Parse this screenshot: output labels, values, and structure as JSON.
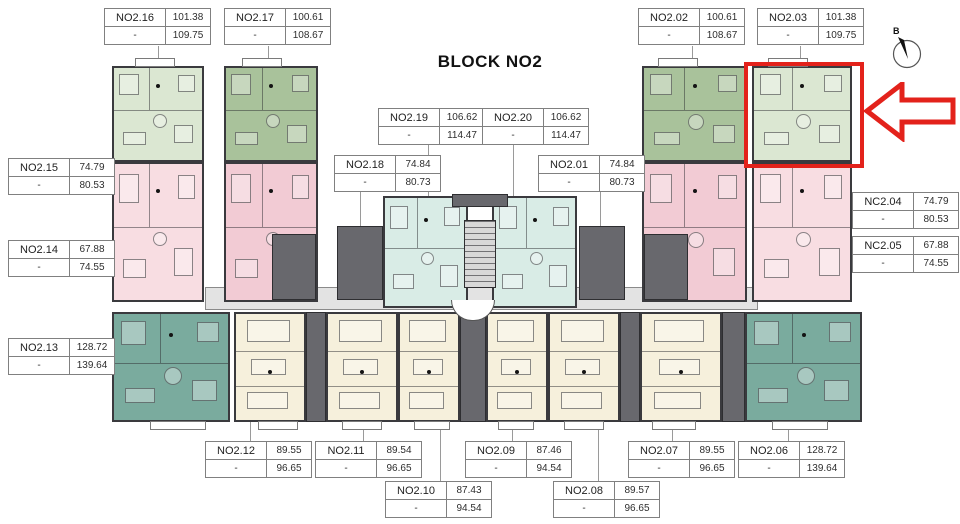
{
  "title": "BLOCK NO2",
  "compass_label": "B",
  "dash": "-",
  "highlighted_unit": "NO2.03",
  "colors": {
    "sage": "#a9c29b",
    "sage_light": "#dbe7d2",
    "pink": "#f2cbd4",
    "pink_light": "#f8dde2",
    "teal": "#7aab9e",
    "teal_light": "#d9ece6",
    "cream": "#f6f0dc",
    "core_gray": "#68686d",
    "stair_bg": "#d8d8d8",
    "corridor": "#e3e3e3",
    "wall": "#3a3a3e",
    "red": "#e3221b",
    "line_gray": "#9a9a9a",
    "table_border": "#808080"
  },
  "tables": [
    {
      "id": "t16",
      "name": "NO2.16",
      "top": "101.38",
      "bottom": "109.75"
    },
    {
      "id": "t17",
      "name": "NO2.17",
      "top": "100.61",
      "bottom": "108.67"
    },
    {
      "id": "t02",
      "name": "NO2.02",
      "top": "100.61",
      "bottom": "108.67"
    },
    {
      "id": "t03",
      "name": "NO2.03",
      "top": "101.38",
      "bottom": "109.75"
    },
    {
      "id": "t19",
      "name": "NO2.19",
      "top": "106.62",
      "bottom": "114.47"
    },
    {
      "id": "t20",
      "name": "NO2.20",
      "top": "106.62",
      "bottom": "114.47"
    },
    {
      "id": "t18",
      "name": "NO2.18",
      "top": "74.84",
      "bottom": "80.73"
    },
    {
      "id": "t01",
      "name": "NO2.01",
      "top": "74.84",
      "bottom": "80.73"
    },
    {
      "id": "t15",
      "name": "NO2.15",
      "top": "74.79",
      "bottom": "80.53"
    },
    {
      "id": "t14",
      "name": "NO2.14",
      "top": "67.88",
      "bottom": "74.55"
    },
    {
      "id": "t13",
      "name": "NO2.13",
      "top": "128.72",
      "bottom": "139.64"
    },
    {
      "id": "t04",
      "name": "NC2.04",
      "top": "74.79",
      "bottom": "80.53"
    },
    {
      "id": "t05",
      "name": "NC2.05",
      "top": "67.88",
      "bottom": "74.55"
    },
    {
      "id": "t12",
      "name": "NO2.12",
      "top": "89.55",
      "bottom": "96.65"
    },
    {
      "id": "t11",
      "name": "NO2.11",
      "top": "89.54",
      "bottom": "96.65"
    },
    {
      "id": "t10",
      "name": "NO2.10",
      "top": "87.43",
      "bottom": "94.54"
    },
    {
      "id": "t09",
      "name": "NO2.09",
      "top": "87.46",
      "bottom": "94.54"
    },
    {
      "id": "t08",
      "name": "NO2.08",
      "top": "89.57",
      "bottom": "96.65"
    },
    {
      "id": "t07",
      "name": "NO2.07",
      "top": "89.55",
      "bottom": "96.65"
    },
    {
      "id": "t06",
      "name": "NO2.06",
      "top": "128.72",
      "bottom": "139.64"
    }
  ]
}
